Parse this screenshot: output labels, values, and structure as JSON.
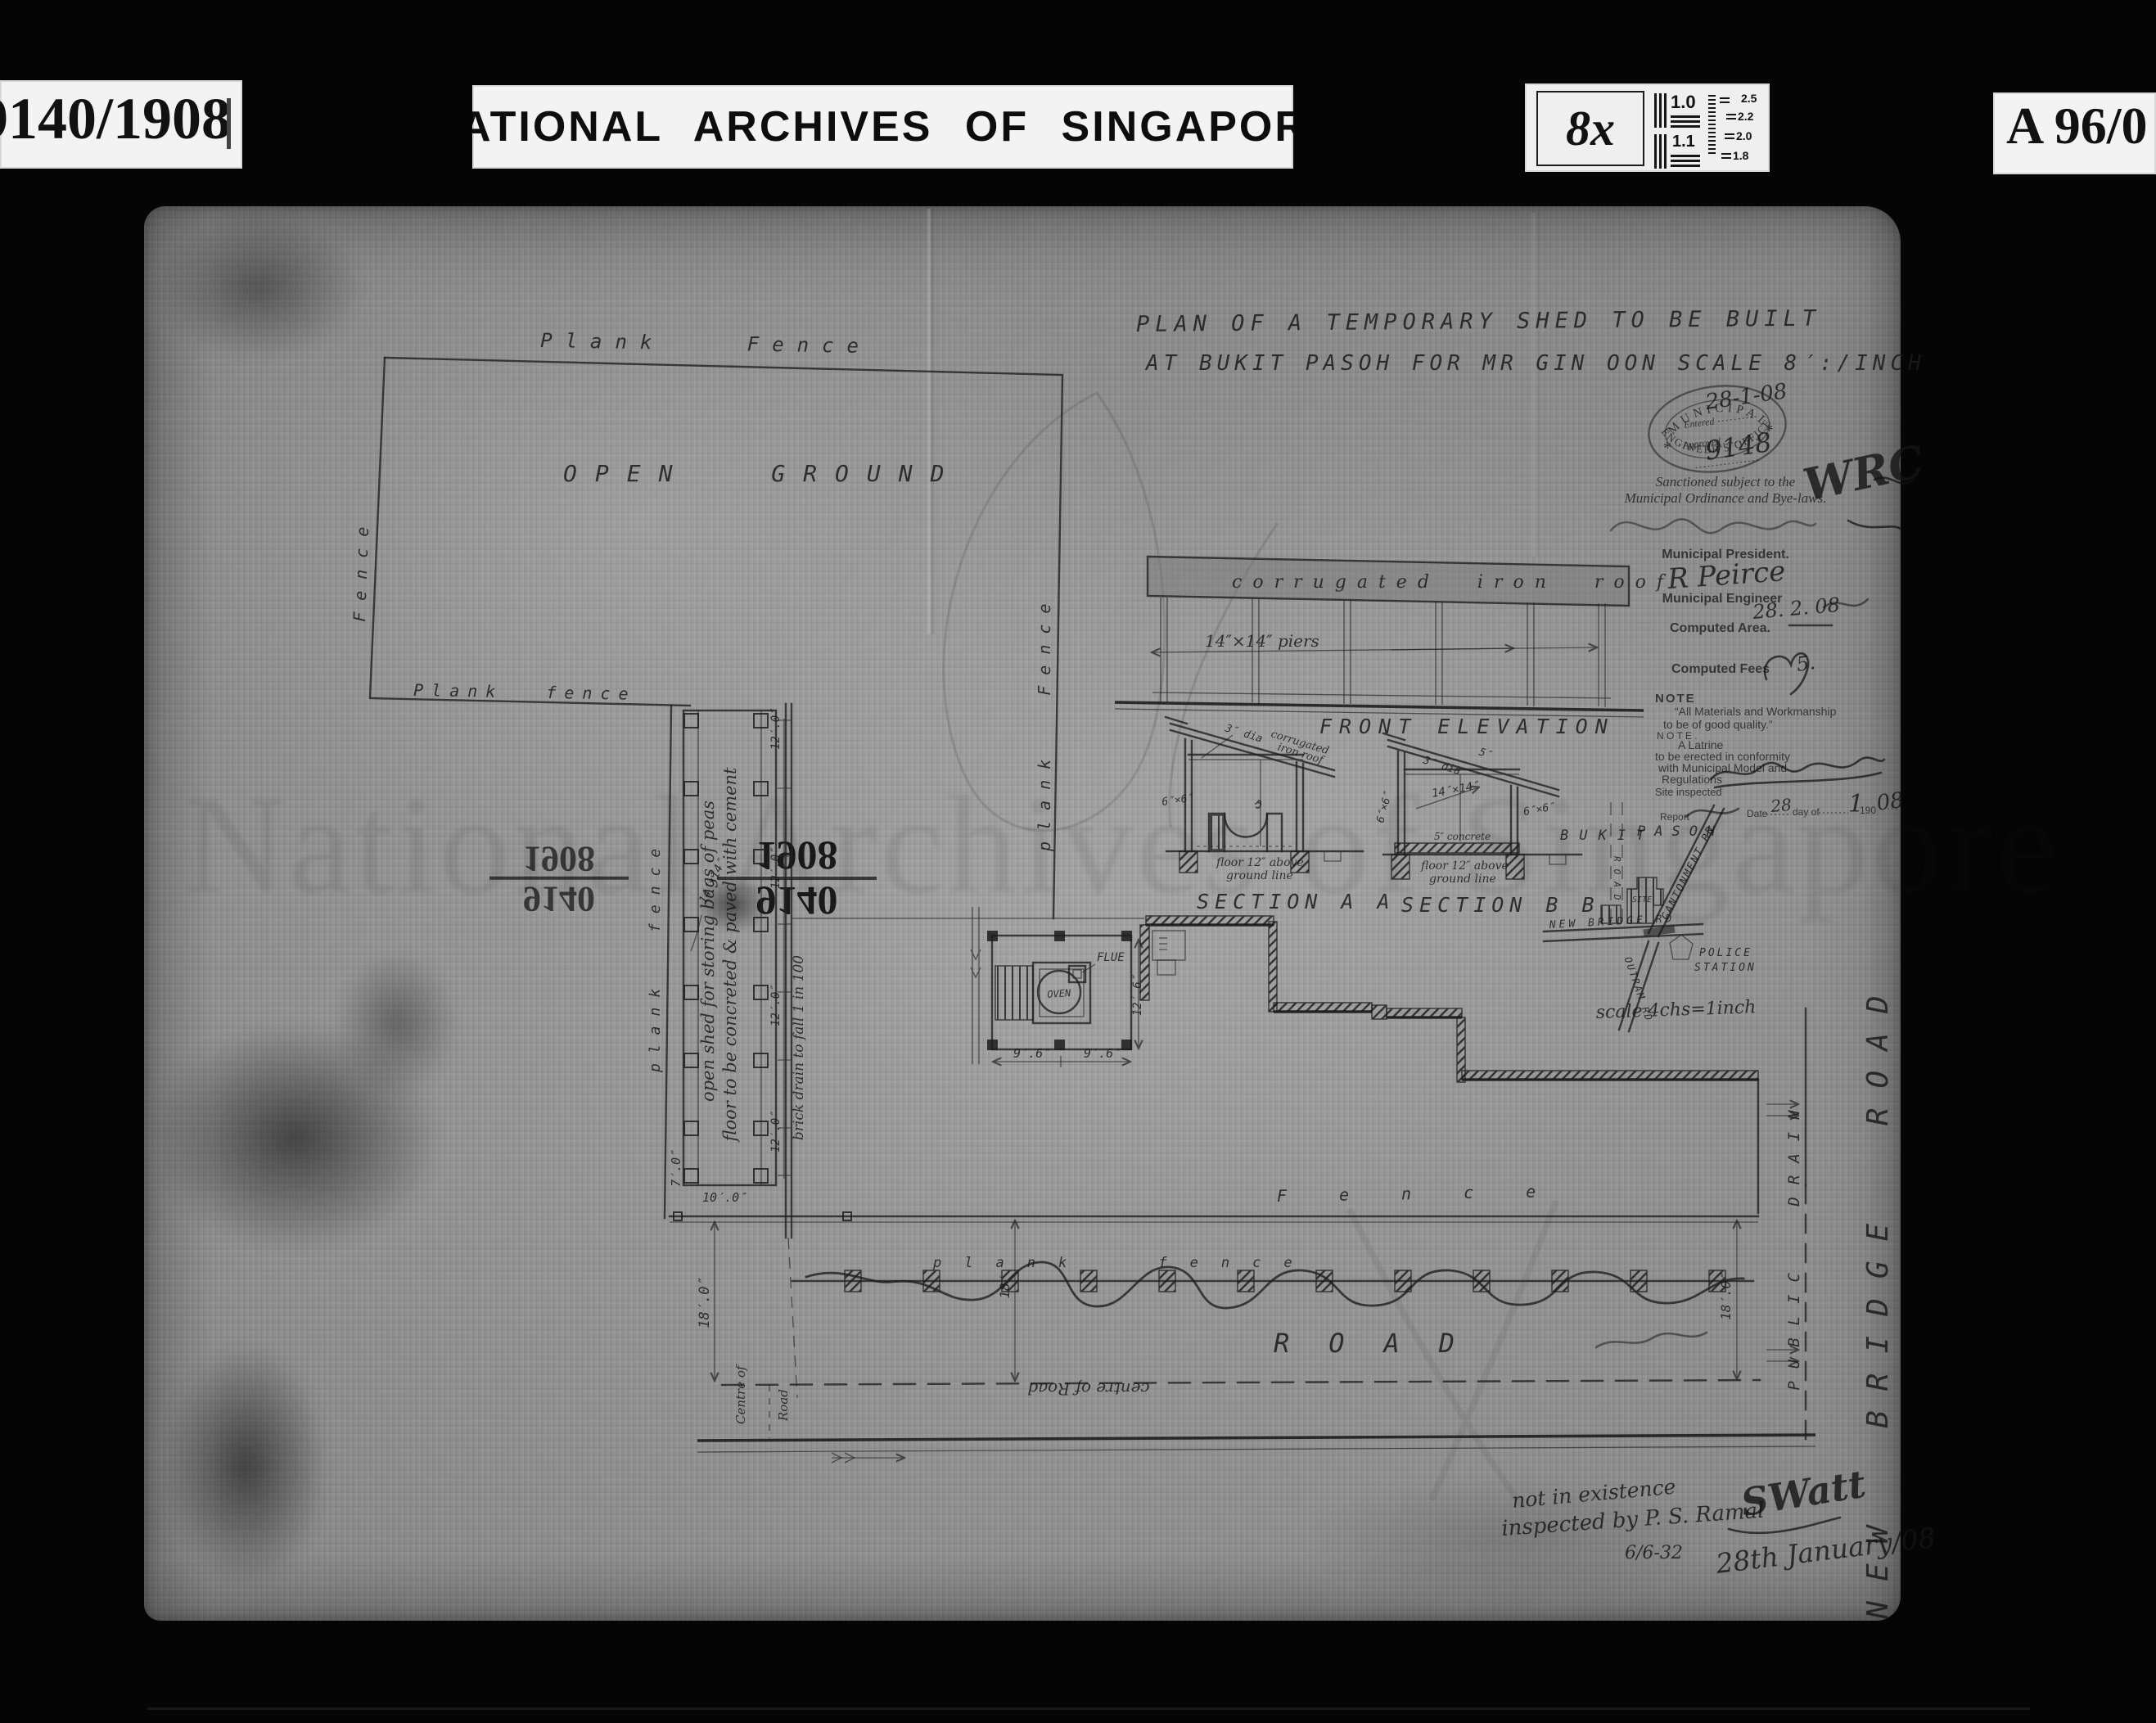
{
  "header": {
    "ref_left": "9140/1908",
    "title": "NATIONAL ARCHIVES OF SINGAPORE",
    "magnification": "8x",
    "ref_right": "A 96/0",
    "chart": {
      "l1": "1.0",
      "l2": "1.1",
      "r1": "2.5",
      "r2": "2.2",
      "r3": "2.0",
      "r4": "1.8"
    }
  },
  "title": {
    "line1": "PLAN OF A TEMPORARY SHED TO BE BUILT",
    "line2": "AT BUKIT PASOH FOR MR GIN OON  SCALE 8′:/INCH"
  },
  "stamp": {
    "arc_top": "MUNICIPAL",
    "arc_bottom": "ENGINEER'S OFFICE",
    "star": "*",
    "entered_label": "Entered",
    "entered_value": "28-1-08",
    "approved_label": "Approved",
    "approved_value": "9148",
    "initials": "WRC"
  },
  "sanction": {
    "line1": "Sanctioned subject to the",
    "line2": "Municipal Ordinance and Bye-laws.",
    "president_label": "Municipal President.",
    "engineer_sig": "R Peirce",
    "engineer_label": "Municipal Engineer",
    "engineer_date": "28. 2. 08",
    "area_label": "Computed Area.",
    "fees_label": "Computed Fees",
    "fees_value": "5."
  },
  "note": {
    "heading": "NOTE",
    "q1": "“All Materials and Workmanship",
    "q2": "to be of good quality.”",
    "heading2": "N O T E .",
    "l1": "A  Latrine",
    "l2": "to be erected in conformity",
    "l3": "with Municipal Model and",
    "l4": "Regulations",
    "site_label": "Site inspected",
    "report_label": "Report",
    "date_label": "Date",
    "date_day": "28",
    "day_of": "day of",
    "date_month": "1",
    "date_year": "190",
    "date_year_hand": "08"
  },
  "elevation": {
    "roof": "corrugated iron roof",
    "piers": "14″×14″ piers",
    "caption": "FRONT ELEVATION"
  },
  "section_aa": {
    "dia": "3″ dia",
    "roof1": "corrugated",
    "roof2": "iron roof",
    "post": "6″×6″",
    "floor1": "floor 12″ above",
    "floor2": "ground line",
    "caption": "SECTION A A"
  },
  "section_bb": {
    "dim5": "5″",
    "dia": "3″ dia",
    "posts_center": "14″×14″",
    "post_left": "6″×6″",
    "post_right": "6″×6″",
    "concrete": "5″ concrete",
    "floor1": "floor 12″ above",
    "floor2": "ground line",
    "caption": "SECTION B B"
  },
  "inset": {
    "bukit": "BUKIT",
    "pasoh": "PASOH",
    "road_small": "ROAD",
    "cantonment": "CANTONMENT RD",
    "new_bridge": "NEW BRIDGE RD",
    "outram": "OUTRAM RD",
    "site": "SITE",
    "police1": "POLICE",
    "police2": "STATION",
    "scale": "scale 4chs=1inch"
  },
  "site": {
    "fence_top": "Plank Fence",
    "fence_left": "Fence",
    "fence_left2": "plank fence",
    "open_ground": "OPEN GROUND",
    "fence_bottom": "Plank fence",
    "fence_right": "plank Fence",
    "shed_line1": "open shed for storing bags of peas",
    "shed_line2": "floor to be concreted & paved with cement",
    "dim_12": "12′.0″",
    "dim_10": "10′.0″",
    "dim_14x14": "14″×14″",
    "dim_7": "7′.0″",
    "drain_label": "brick drain to fall 1 in 100",
    "oven": "OVEN",
    "flue": "FLUE",
    "dim_9_6": "9′.6″",
    "dim_12_6": "12′.6″",
    "fence_row_label": "F e n c e",
    "fence_mid_label": "plank fence",
    "dim_18_left": "18′.0″",
    "dim_18_mid": "18′",
    "dim_18_right": "18′.0″",
    "road": "ROAD",
    "centre_of_road": "centre of Road",
    "centre_left1": "Centre of",
    "centre_left2": "Road",
    "public_drain": "PUBLIC DRAIN",
    "new_bridge_road": "NEW BRIDGE ROAD",
    "bleed_top": "9140",
    "bleed_bottom": "1908"
  },
  "footer": {
    "note1": "not in existence",
    "note2": "inspected by P. S. Ramal",
    "note_date": "6/6-32",
    "signature": "SWatt",
    "date": "28th January/08"
  },
  "watermark": "National Archives of Singapore"
}
